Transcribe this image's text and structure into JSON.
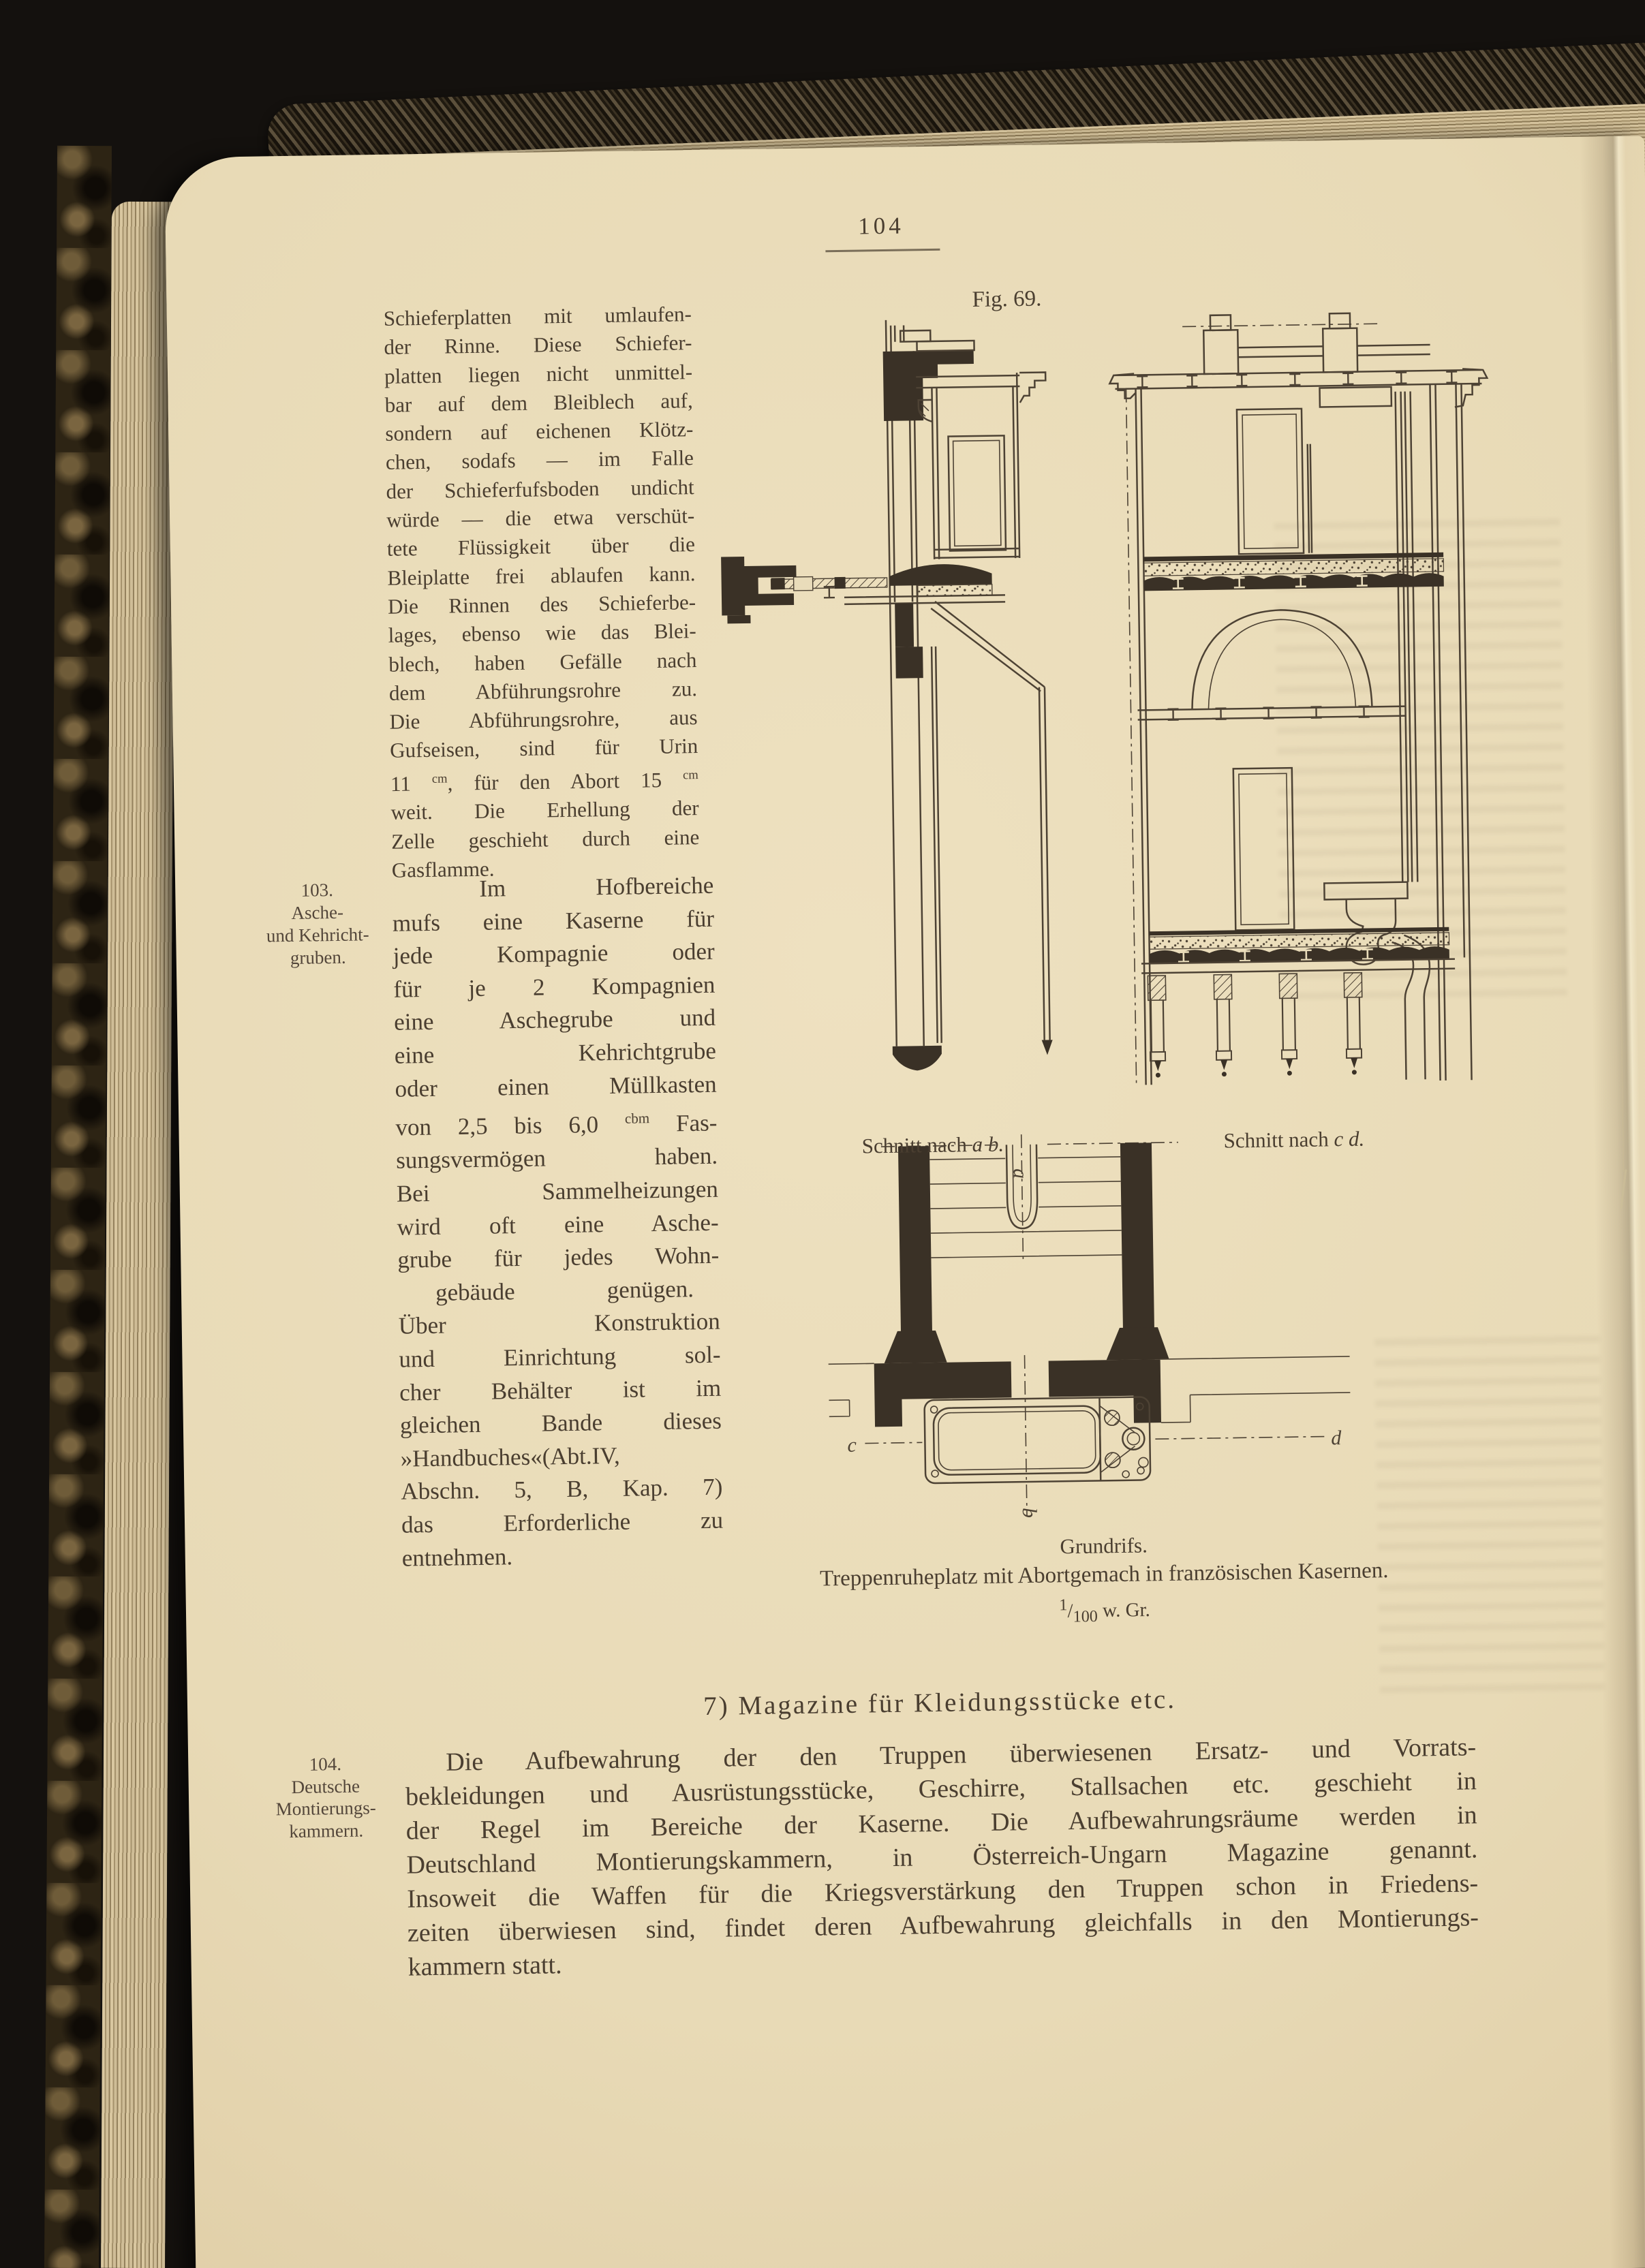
{
  "page_header": {
    "page_number": "104"
  },
  "figure": {
    "label": "Fig. 69.",
    "caption_section_ab": {
      "prefix": "Schnitt nach ",
      "letters": "a b."
    },
    "caption_section_cd": {
      "prefix": "Schnitt nach ",
      "letters": "c d."
    },
    "caption_plan": "Grundrifs.",
    "caption_main": "Treppenruheplatz mit Abortgemach in französischen Kasernen.",
    "scale": {
      "numerator": "1",
      "separator": "/",
      "denominator": "100",
      "suffix": " w. Gr."
    },
    "plan_labels": {
      "a": "a",
      "b": "b",
      "c": "c",
      "d": "d"
    }
  },
  "margin_notes": [
    {
      "id": "103",
      "lines": [
        "103.",
        "Asche-",
        "und Kehricht-",
        "gruben."
      ]
    },
    {
      "id": "104",
      "lines": [
        "104.",
        "Deutsche",
        "Montierungs-",
        "kammern."
      ]
    }
  ],
  "left_column": {
    "para1_lines": [
      "Schieferplatten mit umlaufen-",
      "der Rinne.  Diese Schiefer-",
      "platten liegen nicht unmittel-",
      "bar auf dem Bleiblech auf,",
      "sondern auf eichenen Klötz-",
      "chen, sodafs — im Falle",
      "der Schieferfufsboden undicht",
      "würde –– die etwa verschüt-",
      "tete Flüssigkeit über die",
      "Bleiplatte frei ablaufen kann.",
      "Die Rinnen des Schieferbe-",
      "lages, ebenso wie das Blei-",
      "blech, haben Gefälle nach",
      "dem Abführungsrohre zu.",
      "Die Abführungsrohre, aus",
      "Gufseisen, sind für Urin",
      "11 ^cm^, für den Abort 15 ^cm^",
      "weit.  Die Erhellung der",
      "Zelle geschieht durch eine",
      "Gasflamme."
    ],
    "para2_lines": [
      "Im Hofbereiche",
      "mufs eine Kaserne für",
      "jede Kompagnie oder",
      "für je 2 Kompagnien",
      "eine Aschegrube und",
      "eine Kehrichtgrube",
      "oder einen Müllkasten",
      "von 2,5 bis 6,0 ^cbm^ Fas-",
      "sungsvermögen haben.",
      "Bei Sammelheizungen",
      "wird oft eine Asche-",
      "grube für jedes Wohn-",
      "gebäude genügen.",
      "Über Konstruktion",
      "und Einrichtung sol-",
      "cher Behälter ist im",
      "gleichen Bande dieses",
      "»Handbuches«(Abt.IV,",
      "Abschn. 5, B, Kap. 7)",
      "das Erforderliche zu",
      "entnehmen."
    ]
  },
  "section": {
    "heading": "7) Magazine für Kleidungsstücke etc.",
    "para_lines": [
      "Die Aufbewahrung der den Truppen überwiesenen Ersatz- und Vorrats-",
      "bekleidungen und Ausrüstungsstücke, Geschirre, Stallsachen etc. geschieht in",
      "der Regel im Bereiche der Kaserne.  Die Aufbewahrungsräume werden in",
      "Deutschland Montierungskammern, in Österreich-Ungarn Magazine genannt.",
      "Insoweit die Waffen für die Kriegsverstärkung den Truppen schon in Friedens-",
      "zeiten überwiesen sind, findet deren Aufbewahrung gleichfalls in den Montierungs-",
      "kammern statt."
    ]
  }
}
